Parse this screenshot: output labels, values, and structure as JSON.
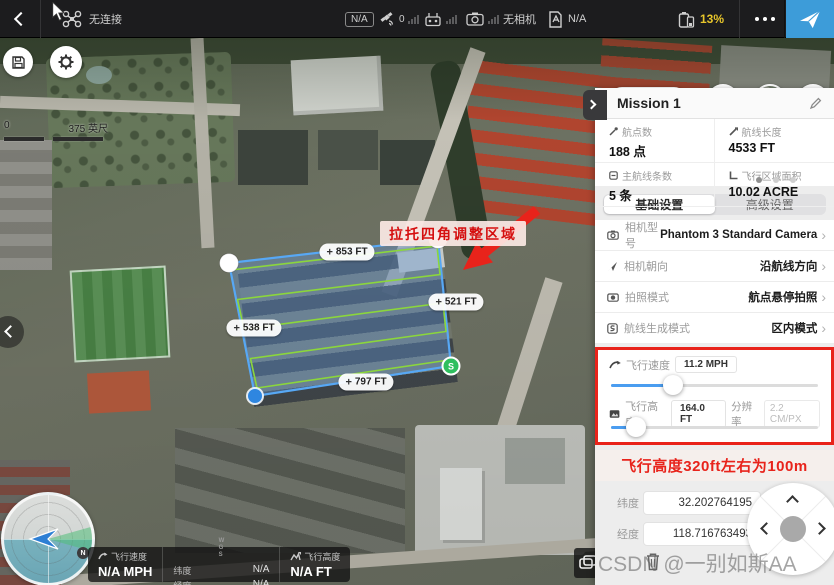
{
  "top_bar": {
    "aircraft_status": "无连接",
    "na_badge": "N/A",
    "gps_count": "0",
    "camera_status": "无相机",
    "sd_status": "N/A",
    "battery": "13%"
  },
  "map": {
    "view_toggle": "2D",
    "scale": {
      "zero": "0",
      "label": "375 英尺"
    },
    "annotation": "拉托四角调整区域",
    "distances": {
      "top": "853 FT",
      "right": "521 FT",
      "left": "538 FT",
      "bottom": "797 FT"
    },
    "start_marker": "S",
    "compass_north": "N"
  },
  "mission_panel": {
    "title": "Mission 1",
    "stats": [
      {
        "label": "航点数",
        "value": "188 点"
      },
      {
        "label": "航线长度",
        "value": "4533 FT"
      },
      {
        "label": "主航线条数",
        "value": "5 条"
      },
      {
        "label": "飞行区域面积",
        "value": "10.02 ACRE"
      }
    ],
    "tabs": [
      {
        "label": "基础设置"
      },
      {
        "label": "高级设置"
      }
    ],
    "settings": [
      {
        "label": "相机型号",
        "value": "Phantom 3 Standard Camera"
      },
      {
        "label": "相机朝向",
        "value": "沿航线方向"
      },
      {
        "label": "拍照模式",
        "value": "航点悬停拍照"
      },
      {
        "label": "航线生成模式",
        "value": "区内模式"
      }
    ],
    "sliders": {
      "speed_label": "飞行速度",
      "speed_value": "11.2 MPH",
      "speed_pct": 30,
      "altitude_label": "飞行高度",
      "altitude_value": "164.0 FT",
      "altitude_pct": 12,
      "resolution_label": "分辨率",
      "resolution_value": "2.2 CM/PX"
    },
    "note": "飞行高度320ft左右为100m",
    "coords": {
      "lat_label": "纬度",
      "lat_value": "32.202764195",
      "lng_label": "经度",
      "lng_value": "118.716763493"
    }
  },
  "telemetry": {
    "speed_label": "飞行速度",
    "speed_value": "N/A MPH",
    "wgs": "WGS",
    "lat_label": "纬度",
    "lat_value": "N/A",
    "lng_label": "经度",
    "lng_value": "N/A",
    "alt_label": "飞行高度",
    "alt_value": "N/A FT"
  },
  "watermark": "CSDN @一别如斯AA",
  "colors": {
    "accent_blue": "#3d9cd9",
    "toggle_blue": "#4f9ff0",
    "battery_yellow": "#e8c62b",
    "alert_red": "#e8231b",
    "route_green": "#8bd63c",
    "polygon_blue": "#57a8f5"
  }
}
